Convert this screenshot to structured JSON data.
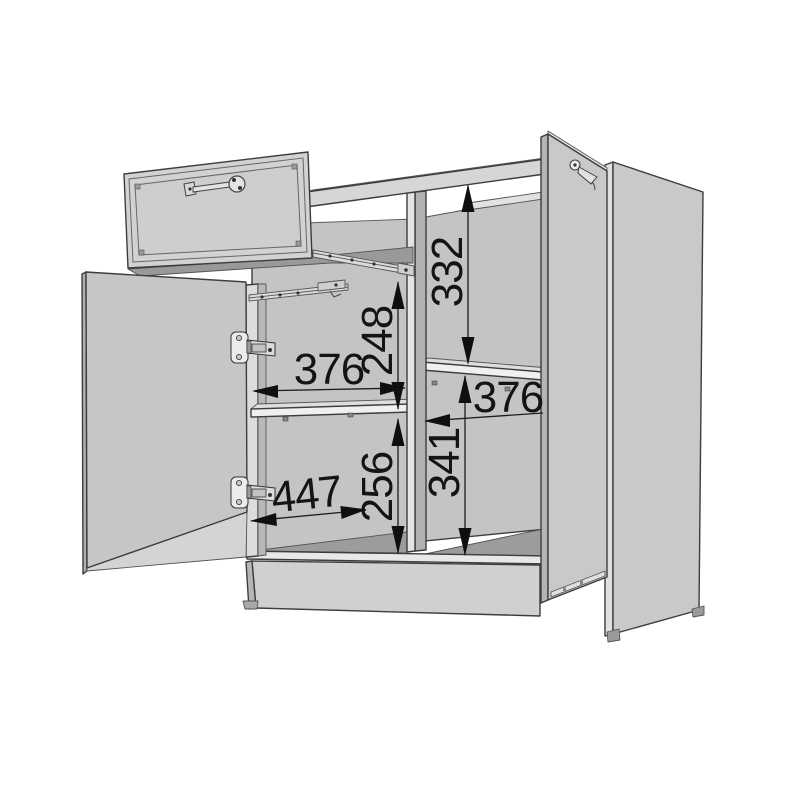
{
  "diagram": {
    "kind": "furniture-assembly-dimension-drawing",
    "subject": "two-door sideboard cabinet with pulled-out drawer, open doors, hinges and shelves"
  },
  "dimensions": {
    "upper_right_height": {
      "value": "332",
      "orientation": "vertical"
    },
    "upper_left_height": {
      "value": "248",
      "orientation": "vertical"
    },
    "left_width": {
      "value": "376",
      "orientation": "horizontal"
    },
    "right_width": {
      "value": "376",
      "orientation": "horizontal"
    },
    "lower_right_height": {
      "value": "341",
      "orientation": "vertical"
    },
    "lower_left_height": {
      "value": "256",
      "orientation": "vertical"
    },
    "bottom_depth": {
      "value": "447",
      "orientation": "diagonal"
    }
  },
  "colors": {
    "background": "#ffffff",
    "panel": "#cdcdcd",
    "panel_dark": "#9c9c9c",
    "panel_edge_light": "#e8e8e8",
    "outline": "#3d3d3d",
    "dimension_ink": "#141414"
  }
}
